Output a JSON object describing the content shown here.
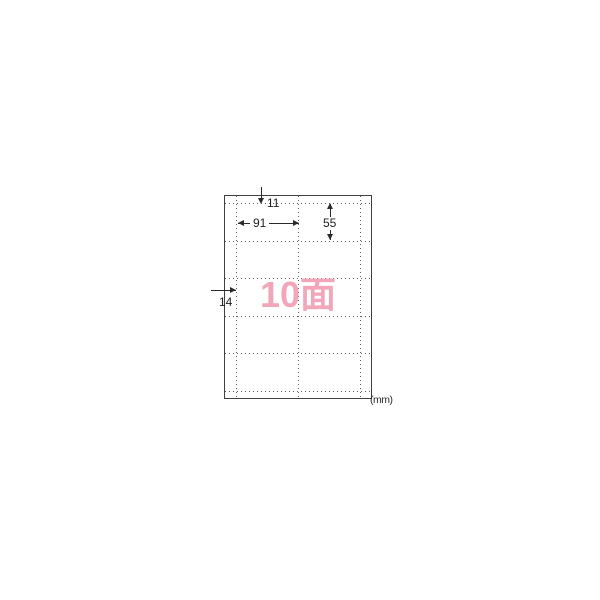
{
  "diagram": {
    "face_count_label": "10面",
    "unit_label": "(mm)",
    "dimensions": {
      "top_margin_mm": "11",
      "cell_width_mm": "91",
      "cell_height_mm": "55",
      "left_margin_mm": "14"
    },
    "grid": {
      "rows": 5,
      "columns": 2,
      "total_faces": 10
    },
    "colors": {
      "face_label_pink": "#F2A6BA",
      "solid_line": "#404040",
      "dotted_line": "#5d5d5d",
      "dimension_line": "#2b2b2b",
      "background": "#ffffff"
    }
  }
}
